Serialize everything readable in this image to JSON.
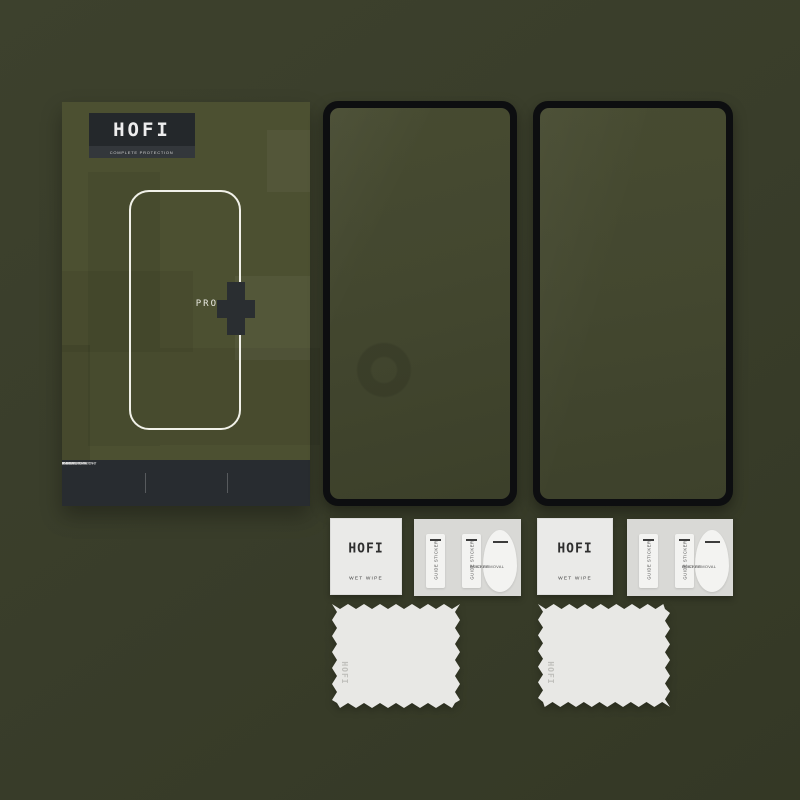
{
  "colors": {
    "background": "#3a3e2b",
    "box_face": "#4c5031",
    "dark_panel": "#25292d",
    "glass_tint": "#43472f",
    "item_white": "#eaeae8",
    "logo_white": "#eeeeee"
  },
  "box": {
    "brand": "HOFI",
    "tagline": "COMPLETE PROTECTION",
    "model": "PRO",
    "plus": "+",
    "features": [
      {
        "line1": "ANTI",
        "line2": "FINGERPRINT"
      },
      {
        "line1": "SCRATCH",
        "line2": "RESISTANT"
      },
      {
        "line1": "IMPACT",
        "line2": "ABSORPTION"
      }
    ]
  },
  "accessories": {
    "wet_wipe": {
      "brand": "HOFI",
      "label": "WET WIPE"
    },
    "guide_sticker": {
      "label": "GUIDE STICKER"
    },
    "dust_removal": {
      "line1": "DUST REMOVAL",
      "line2": "STICKER"
    },
    "cloth": {
      "brand": "HOFI"
    }
  }
}
